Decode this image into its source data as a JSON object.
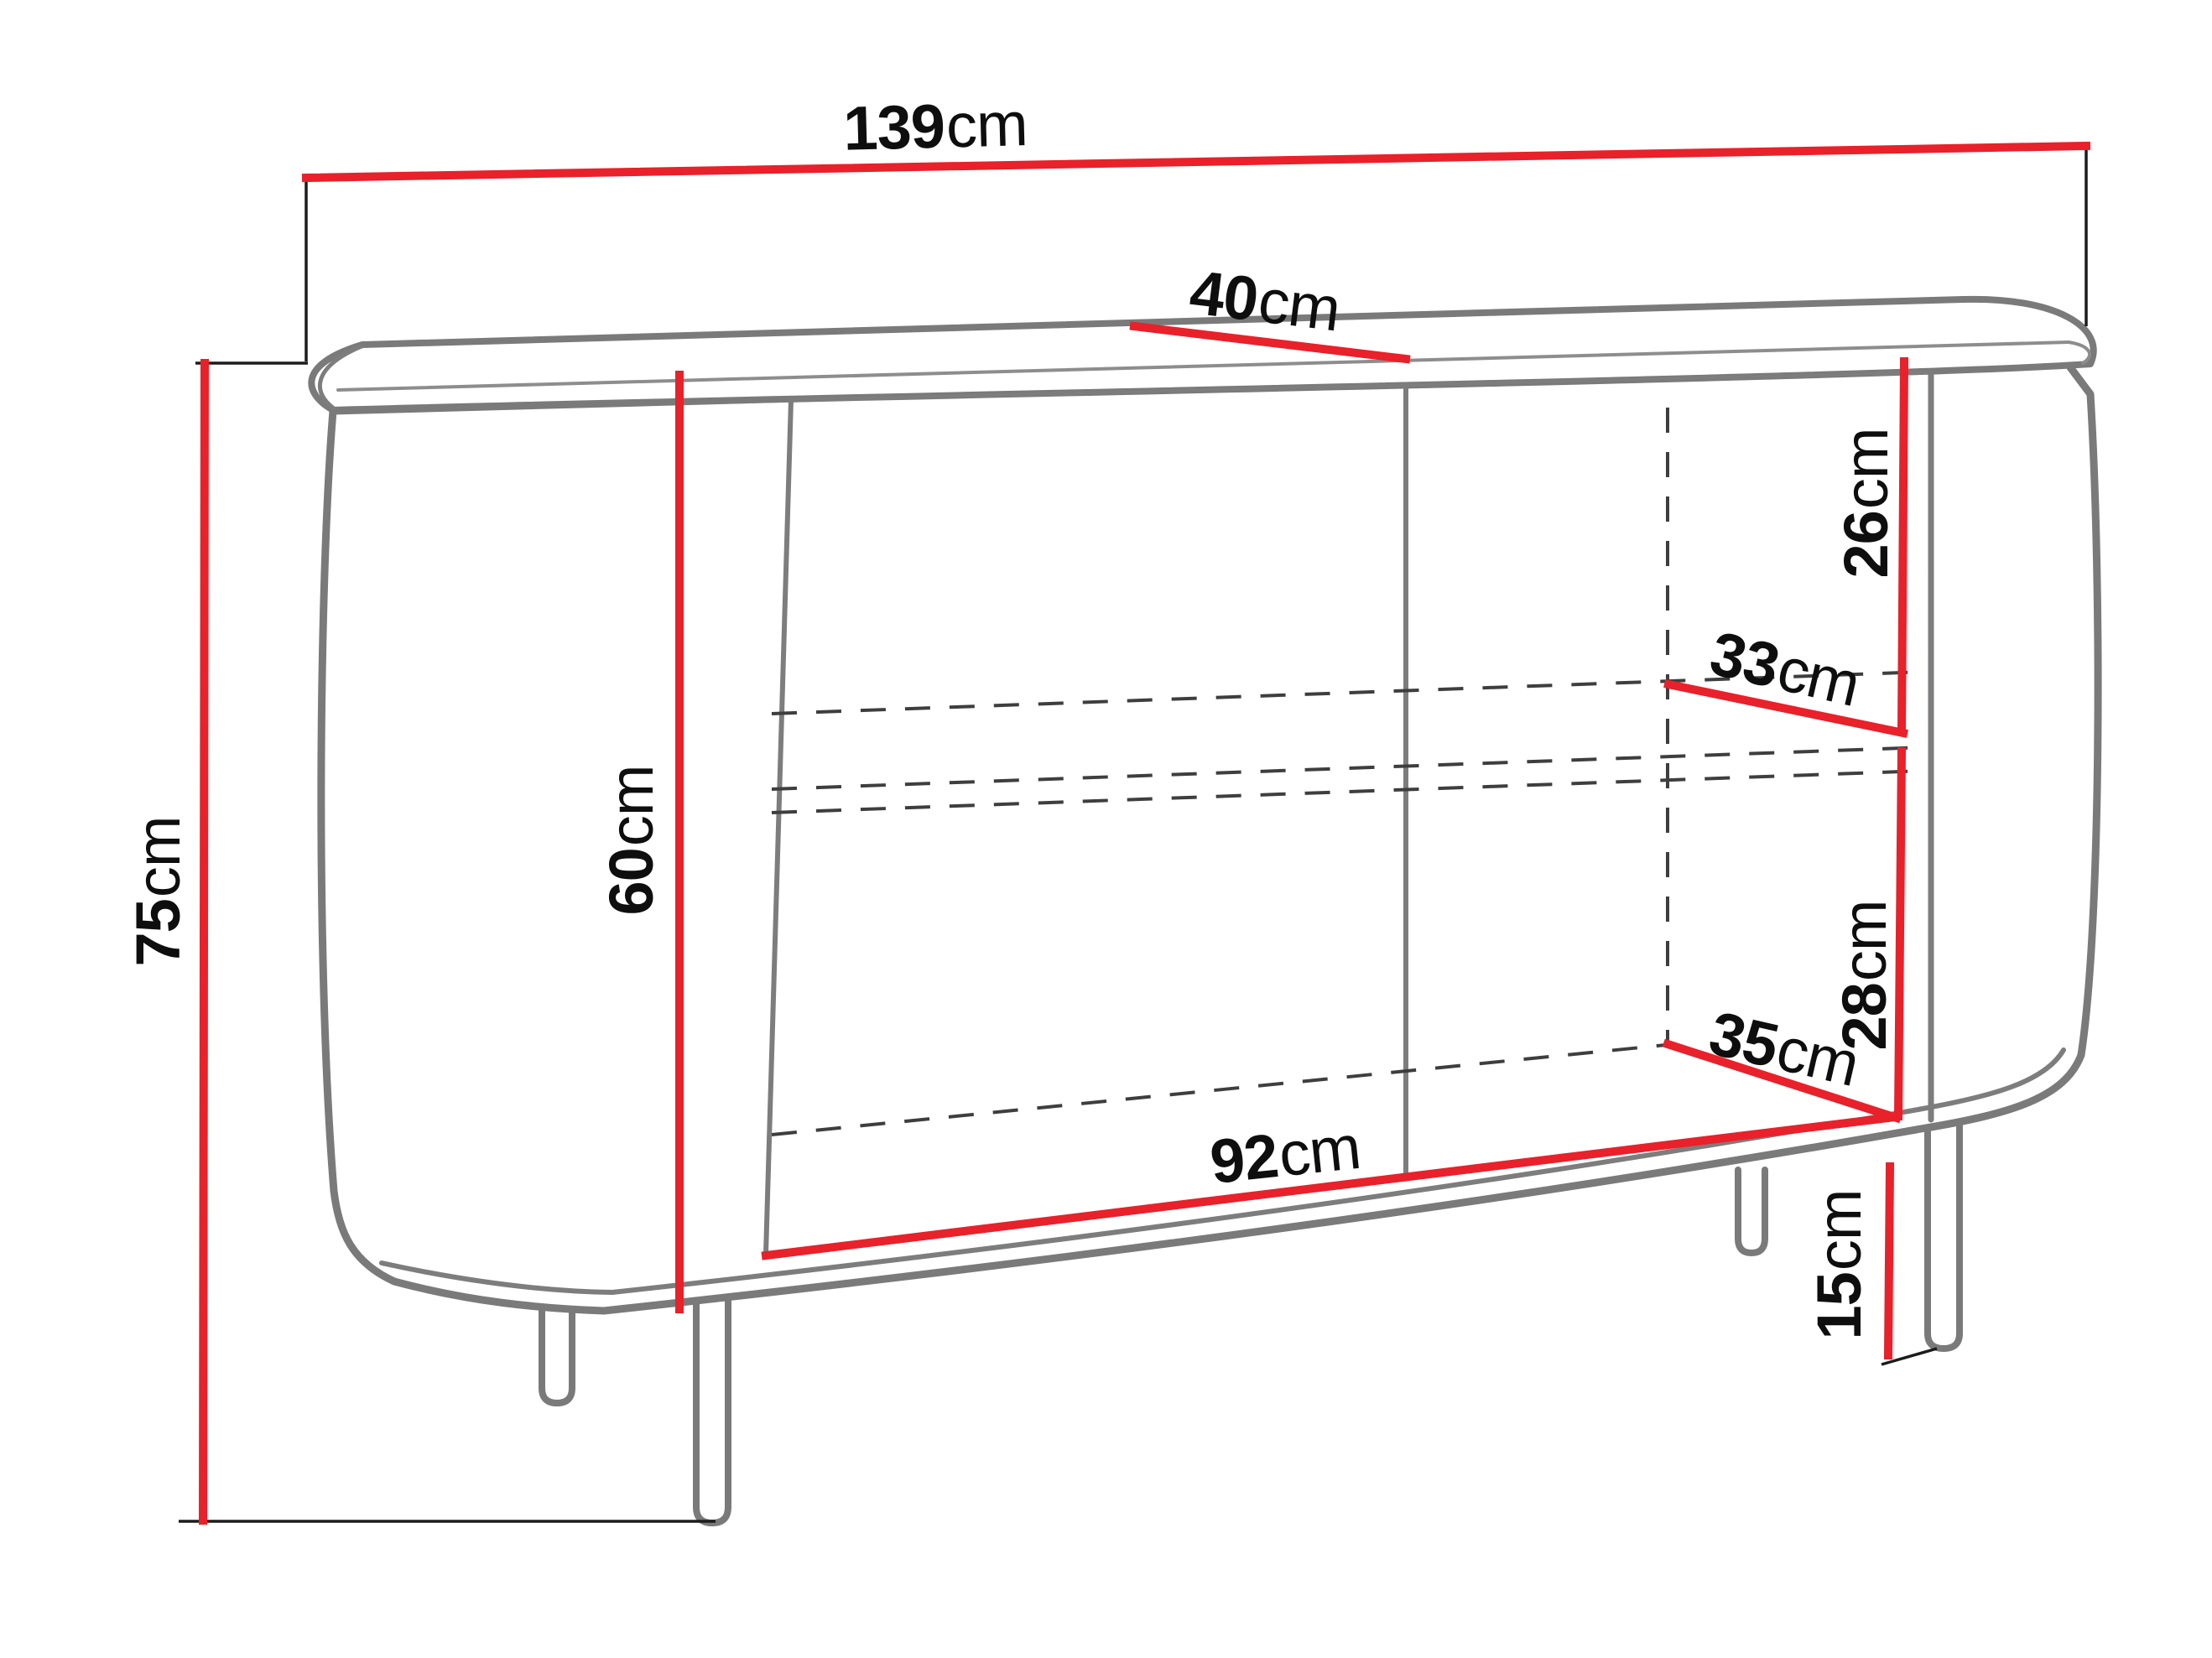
{
  "diagram": {
    "type": "furniture-dimension-diagram",
    "subject": "sideboard-cabinet-perspective-line-drawing",
    "unit": "cm",
    "colors": {
      "dimension_line": "#e8212a",
      "cabinet_outline": "#7a7a7a",
      "hidden_edge_dash": "#3e3e3e",
      "extension_line": "#1c1c1c",
      "label_text": "#0e0e0e",
      "background": "#ffffff"
    },
    "dims": {
      "d139": {
        "num": "139",
        "unit": "cm",
        "value": 139
      },
      "d40": {
        "num": "40",
        "unit": "cm",
        "value": 40
      },
      "d75": {
        "num": "75",
        "unit": "cm",
        "value": 75
      },
      "d60": {
        "num": "60",
        "unit": "cm",
        "value": 60
      },
      "d26": {
        "num": "26",
        "unit": "cm",
        "value": 26
      },
      "d33": {
        "num": "33",
        "unit": "cm",
        "value": 33
      },
      "d28": {
        "num": "28",
        "unit": "cm",
        "value": 28
      },
      "d35": {
        "num": "35",
        "unit": "cm",
        "value": 35
      },
      "d92": {
        "num": "92",
        "unit": "cm",
        "value": 92
      },
      "d15": {
        "num": "15",
        "unit": "cm",
        "value": 15
      }
    }
  }
}
